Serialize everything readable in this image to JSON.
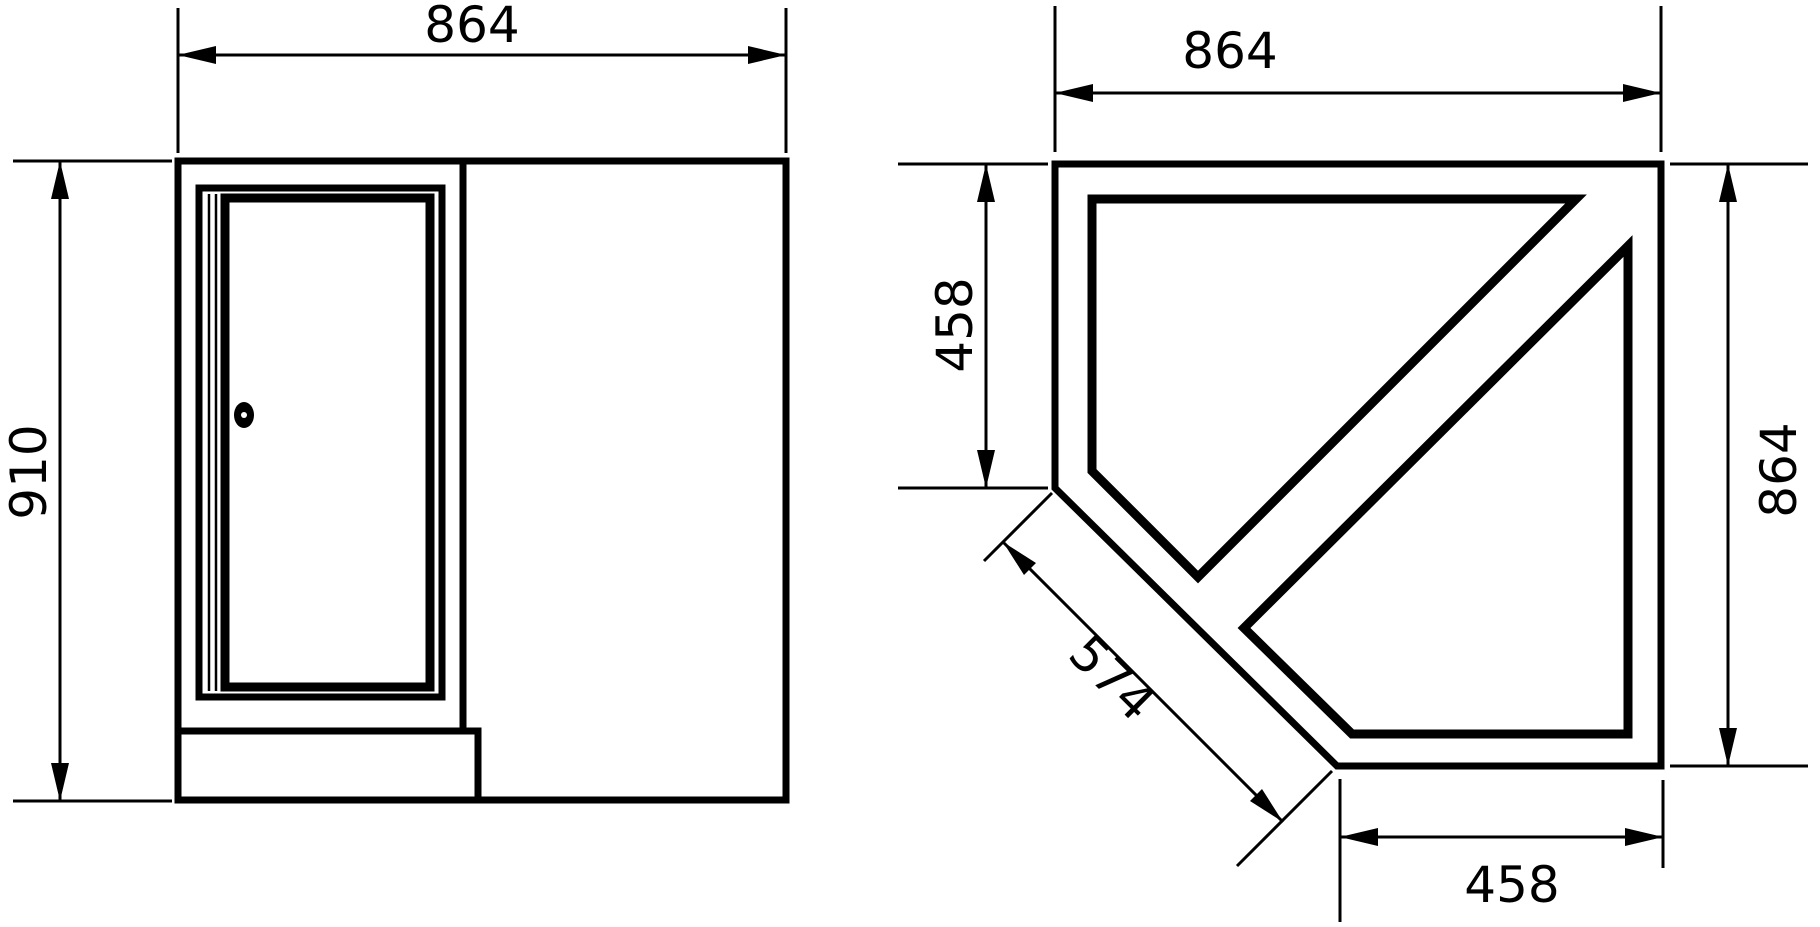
{
  "page": {
    "background": "#ffffff",
    "line_color": "#000000"
  },
  "drawing": {
    "kind": "furniture-corner-cabinet-dimension-drawing",
    "views": {
      "front": {
        "title": "front-view",
        "dims": {
          "width": {
            "value": "864"
          },
          "height": {
            "value": "910"
          }
        },
        "features": {
          "door": "door-panel-with-inner-frame",
          "hinge": "double-hinge-lines-left",
          "lock": "cylinder-lock",
          "plinth": "base-plinth-step"
        }
      },
      "plan": {
        "title": "plan-view-corner-pentagon",
        "dims": {
          "width": {
            "value": "864"
          },
          "depth": {
            "value": "864"
          },
          "left_side": {
            "value": "458"
          },
          "bottom_side": {
            "value": "458"
          },
          "diagonal": {
            "value": "574"
          }
        },
        "features": {
          "upper_panel": "back-panel-outline",
          "lower_panel": "side-panel-outline"
        }
      }
    }
  }
}
